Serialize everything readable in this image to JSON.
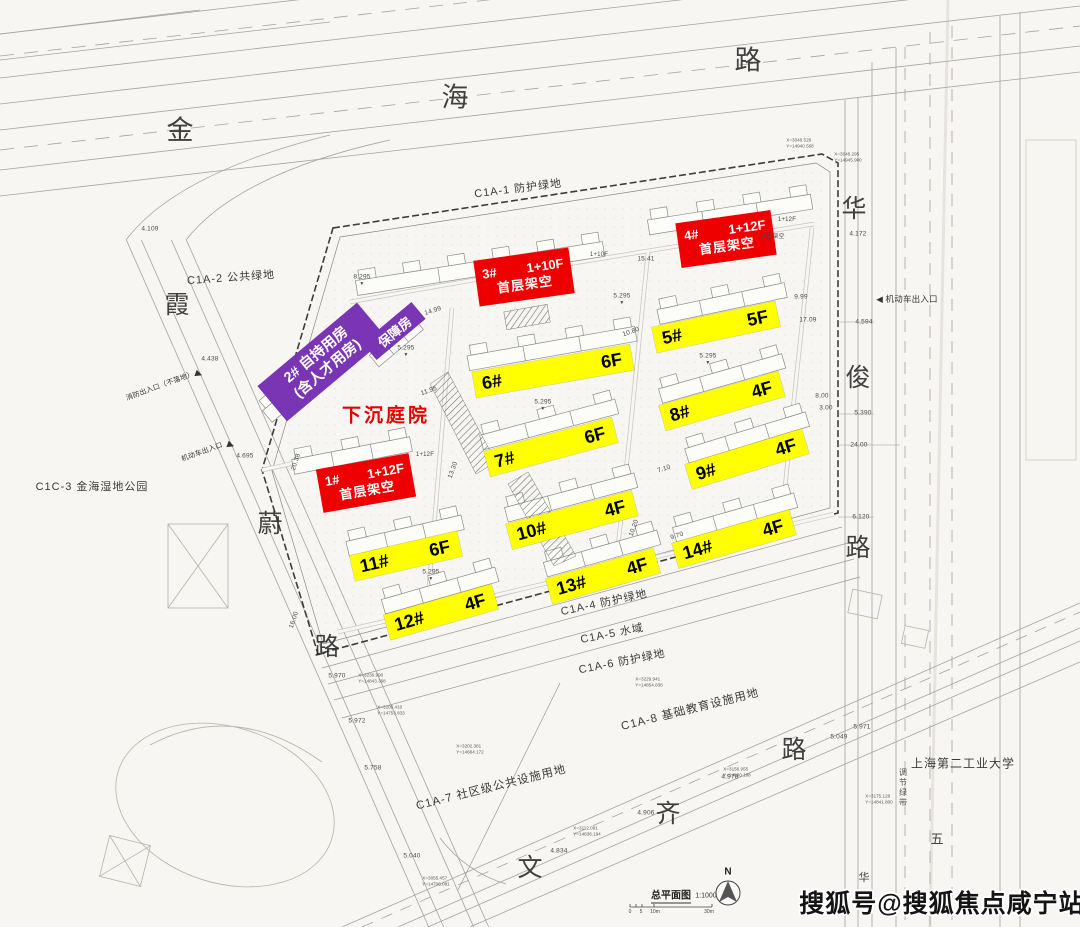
{
  "colors": {
    "yellow": "#ffff00",
    "red": "#ee0000",
    "purple": "#7a35b5",
    "red_text": "#e60000"
  },
  "road_chars": [
    {
      "ch": "金",
      "x": 180,
      "y": 128,
      "s": 27
    },
    {
      "ch": "海",
      "x": 455,
      "y": 95,
      "s": 27
    },
    {
      "ch": "路",
      "x": 748,
      "y": 58,
      "s": 27
    },
    {
      "ch": "华",
      "x": 854,
      "y": 207
    },
    {
      "ch": "俊",
      "x": 858,
      "y": 376
    },
    {
      "ch": "路",
      "x": 858,
      "y": 546
    },
    {
      "ch": "霞",
      "x": 177,
      "y": 303
    },
    {
      "ch": "蔚",
      "x": 270,
      "y": 522
    },
    {
      "ch": "路",
      "x": 327,
      "y": 645
    },
    {
      "ch": "文",
      "x": 530,
      "y": 866
    },
    {
      "ch": "齐",
      "x": 668,
      "y": 812
    },
    {
      "ch": "路",
      "x": 794,
      "y": 748
    },
    {
      "ch": "五",
      "x": 937,
      "y": 838,
      "s": 13
    },
    {
      "ch": "华",
      "x": 864,
      "y": 877,
      "s": 11
    }
  ],
  "area_labels": [
    {
      "t": "C1A-1 防护绿地",
      "x": 518,
      "y": 188,
      "rot": -7
    },
    {
      "t": "C1A-2 公共绿地",
      "x": 231,
      "y": 277,
      "rot": -4
    },
    {
      "t": "C1C-3 金海湿地公园",
      "x": 92,
      "y": 486,
      "rot": 0
    },
    {
      "t": "C1A-4 防护绿地",
      "x": 604,
      "y": 602,
      "rot": -12
    },
    {
      "t": "C1A-5 水域",
      "x": 612,
      "y": 633,
      "rot": -11
    },
    {
      "t": "C1A-6 防护绿地",
      "x": 622,
      "y": 661,
      "rot": -11
    },
    {
      "t": "C1A-7 社区级公共设施用地",
      "x": 491,
      "y": 787,
      "rot": -14,
      "s": 11.5
    },
    {
      "t": "C1A-8 基础教育设施用地",
      "x": 690,
      "y": 709,
      "rot": -14,
      "s": 11.5
    },
    {
      "t": "上海第二工业大学",
      "x": 963,
      "y": 763,
      "rot": 0,
      "s": 12
    }
  ],
  "building_labels": [
    {
      "num": "5#",
      "floor": "5F",
      "x": 716,
      "y": 327,
      "w": 126,
      "rot": -12
    },
    {
      "num": "6#",
      "floor": "6F",
      "x": 553,
      "y": 371,
      "w": 160,
      "rot": -10
    },
    {
      "num": "8#",
      "floor": "4F",
      "x": 722,
      "y": 401,
      "w": 124,
      "rot": -16
    },
    {
      "num": "7#",
      "floor": "6F",
      "x": 551,
      "y": 447,
      "w": 132,
      "rot": -15
    },
    {
      "num": "9#",
      "floor": "4F",
      "x": 747,
      "y": 459,
      "w": 122,
      "rot": -17
    },
    {
      "num": "10#",
      "floor": "4F",
      "x": 572,
      "y": 520,
      "w": 130,
      "rot": -15
    },
    {
      "num": "14#",
      "floor": "4F",
      "x": 734,
      "y": 539,
      "w": 122,
      "rot": -16
    },
    {
      "num": "11#",
      "floor": "6F",
      "x": 406,
      "y": 556,
      "w": 110,
      "rot": -13
    },
    {
      "num": "13#",
      "floor": "4F",
      "x": 603,
      "y": 576,
      "w": 112,
      "rot": -16
    },
    {
      "num": "12#",
      "floor": "4F",
      "x": 441,
      "y": 612,
      "w": 112,
      "rot": -16
    }
  ],
  "red_labels": [
    {
      "num": "3#",
      "spec": "1+10F",
      "note": "首层架空",
      "x": 524,
      "y": 277,
      "w": 96,
      "h": 46,
      "rot": -8
    },
    {
      "num": "4#",
      "spec": "1+12F",
      "note": "首层架空",
      "x": 726,
      "y": 239,
      "w": 96,
      "h": 45,
      "rot": -8
    },
    {
      "num": "1#",
      "spec": "1+12F",
      "note": "首层架空",
      "x": 366,
      "y": 483,
      "w": 94,
      "h": 44,
      "rot": -10
    }
  ],
  "purple_main": [
    {
      "l1": "2# 自持用房",
      "l2": "(含人才用房)",
      "x": 322,
      "y": 362,
      "w": 130,
      "h": 46,
      "rot": -40
    }
  ],
  "purple_tag": [
    {
      "t": "保障房",
      "x": 394,
      "y": 331,
      "w": 64,
      "h": 22,
      "rot": -40
    }
  ],
  "sunken": [
    {
      "t": "下沉庭院",
      "x": 386,
      "y": 414
    }
  ],
  "entrances": [
    {
      "t": "消防出入口（不落地）",
      "x": 160,
      "y": 386,
      "rot": -20,
      "s": 7
    },
    {
      "t": "机动车出入口",
      "x": 202,
      "y": 452,
      "rot": -20,
      "s": 7
    },
    {
      "t": "◀ 机动车出入口",
      "x": 907,
      "y": 299,
      "rot": 0,
      "s": 8.5
    },
    {
      "t": "▶",
      "x": 199,
      "y": 374,
      "rot": 20,
      "s": 9
    },
    {
      "t": "▶",
      "x": 231,
      "y": 445,
      "rot": 20,
      "s": 9
    }
  ],
  "annotations": [
    {
      "t": "4.109",
      "x": 150,
      "y": 229
    },
    {
      "t": "4.438",
      "x": 210,
      "y": 359
    },
    {
      "t": "4.695",
      "x": 245,
      "y": 456
    },
    {
      "t": "4.172",
      "x": 858,
      "y": 234
    },
    {
      "t": "4.594",
      "x": 864,
      "y": 322
    },
    {
      "t": "9.99",
      "x": 801,
      "y": 297
    },
    {
      "t": "17.09",
      "x": 808,
      "y": 320
    },
    {
      "t": "8.00",
      "x": 822,
      "y": 396
    },
    {
      "t": "3.00",
      "x": 826,
      "y": 408
    },
    {
      "t": "5.390",
      "x": 863,
      "y": 413
    },
    {
      "t": "24.00",
      "x": 859,
      "y": 445
    },
    {
      "t": "6.120",
      "x": 861,
      "y": 517
    },
    {
      "t": "5.970",
      "x": 337,
      "y": 676
    },
    {
      "t": "5.972",
      "x": 357,
      "y": 721
    },
    {
      "t": "5.758",
      "x": 373,
      "y": 768
    },
    {
      "t": "5.040",
      "x": 412,
      "y": 856
    },
    {
      "t": "4.834",
      "x": 559,
      "y": 851
    },
    {
      "t": "4.906",
      "x": 646,
      "y": 813
    },
    {
      "t": "4.978",
      "x": 730,
      "y": 777
    },
    {
      "t": "5.049",
      "x": 839,
      "y": 737
    },
    {
      "t": "5.971",
      "x": 862,
      "y": 727
    },
    {
      "t": "8.295",
      "x": 362,
      "y": 277
    },
    {
      "t": "5.295",
      "x": 406,
      "y": 348
    },
    {
      "t": "5.295",
      "x": 543,
      "y": 402
    },
    {
      "t": "5.295",
      "x": 622,
      "y": 296
    },
    {
      "t": "5.295",
      "x": 431,
      "y": 572
    },
    {
      "t": "5.295",
      "x": 708,
      "y": 356
    },
    {
      "t": "▼",
      "x": 406,
      "y": 355,
      "s": 5
    },
    {
      "t": "▼",
      "x": 543,
      "y": 409,
      "s": 5
    },
    {
      "t": "▼",
      "x": 622,
      "y": 303,
      "s": 5
    },
    {
      "t": "▼",
      "x": 431,
      "y": 579,
      "s": 5
    },
    {
      "t": "▼",
      "x": 708,
      "y": 363,
      "s": 5
    },
    {
      "t": "▼",
      "x": 362,
      "y": 284,
      "s": 5
    },
    {
      "t": "14.99",
      "x": 433,
      "y": 311,
      "rot": -18
    },
    {
      "t": "15.41",
      "x": 646,
      "y": 259
    },
    {
      "t": "11.95",
      "x": 429,
      "y": 391,
      "rot": -20
    },
    {
      "t": "13.30",
      "x": 453,
      "y": 470,
      "rot": -70
    },
    {
      "t": "10.80",
      "x": 631,
      "y": 332,
      "rot": -20
    },
    {
      "t": "10.20",
      "x": 634,
      "y": 528,
      "rot": -70
    },
    {
      "t": "9.70",
      "x": 677,
      "y": 536,
      "rot": -18
    },
    {
      "t": "7.10",
      "x": 664,
      "y": 469,
      "rot": -18
    },
    {
      "t": "20.38",
      "x": 296,
      "y": 462,
      "rot": -72
    },
    {
      "t": "16.00",
      "x": 294,
      "y": 620,
      "rot": -72
    },
    {
      "t": "1+10F",
      "x": 599,
      "y": 255,
      "s": 6
    },
    {
      "t": "1+12F",
      "x": 787,
      "y": 220,
      "s": 6
    },
    {
      "t": "首层架空",
      "x": 773,
      "y": 236,
      "s": 5.5
    },
    {
      "t": "1+12F",
      "x": 425,
      "y": 455,
      "s": 6
    }
  ],
  "coords": [
    {
      "a": "X=3048.529",
      "b": "Y=14940.568",
      "x": 800,
      "y": 143
    },
    {
      "a": "X=3046.295",
      "b": "Y=14945.900",
      "x": 848,
      "y": 157
    },
    {
      "a": "X=3236.990",
      "b": "Y=14843.368",
      "x": 372,
      "y": 678
    },
    {
      "a": "X=3209.410",
      "b": "Y=14753.833",
      "x": 391,
      "y": 710
    },
    {
      "a": "X=3202.381",
      "b": "Y=14684.172",
      "x": 470,
      "y": 749
    },
    {
      "a": "X=3229.941",
      "b": "Y=14854.838",
      "x": 649,
      "y": 682
    },
    {
      "a": "X=3112.091",
      "b": "Y=14836.194",
      "x": 587,
      "y": 831
    },
    {
      "a": "X=3156.955",
      "b": "Y=14800.188",
      "x": 737,
      "y": 772
    },
    {
      "a": "X=3175.128",
      "b": "Y=14841.800",
      "x": 879,
      "y": 799
    },
    {
      "a": "X=3055.457",
      "b": "Y=14706.081",
      "x": 436,
      "y": 881
    }
  ],
  "vert_text": [
    {
      "t": "调节绿带",
      "x": 903,
      "y": 788
    }
  ],
  "legend": {
    "title": "总平面图",
    "scale": "1:1000",
    "north": "N"
  },
  "legend_pos": {
    "title": [
      671,
      895
    ],
    "scale": [
      706,
      896
    ],
    "north": [
      728,
      872
    ]
  },
  "scale_ticks": [
    {
      "t": "0",
      "x": 630,
      "y": 912
    },
    {
      "t": "5",
      "x": 641,
      "y": 912
    },
    {
      "t": "10m",
      "x": 655,
      "y": 912
    },
    {
      "t": "30m",
      "x": 709,
      "y": 912
    }
  ],
  "watermark": [
    {
      "t": "搜狐号@搜狐焦点咸宁站",
      "x": 942,
      "y": 902
    }
  ]
}
